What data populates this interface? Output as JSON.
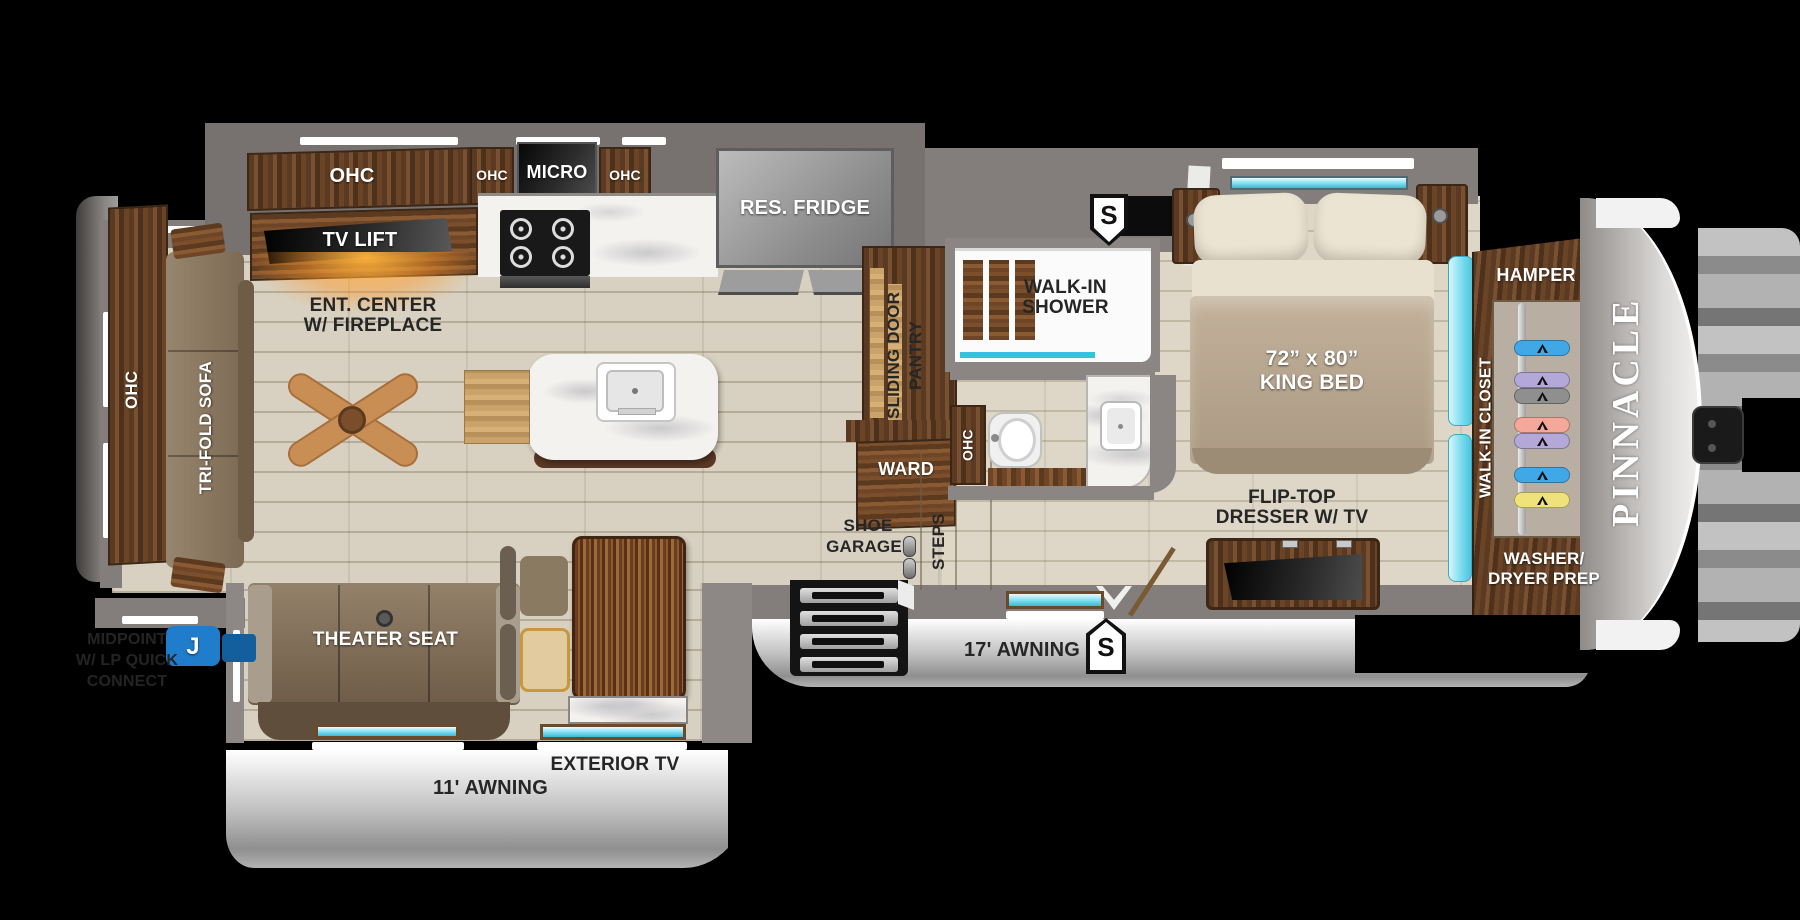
{
  "floorplan": {
    "model_badge": "Pinnacle",
    "colors": {
      "accent_teal": "#4cc3dd",
      "marker_blue": "#1f7dcb",
      "glow_orange": "#f7a832"
    },
    "living": {
      "ohc_rear": "OHC",
      "trifold_sofa": "TRI-FOLD SOFA",
      "theater_seat": "THEATER SEAT",
      "ent_center_l1": "ENT. CENTER",
      "ent_center_l2": "W/ FIREPLACE",
      "tv_lift": "TV LIFT"
    },
    "kitchen": {
      "ohc_main": "OHC",
      "ohc_left": "OHC",
      "micro": "MICRO",
      "ohc_right": "OHC",
      "fridge": "RES. FRIDGE",
      "pantry_l1": "SLIDING DOOR",
      "pantry_l2": "PANTRY",
      "ward": "WARD"
    },
    "entry": {
      "shoe_garage_l1": "SHOE",
      "shoe_garage_l2": "GARAGE",
      "steps": "STEPS"
    },
    "bath": {
      "shower_l1": "WALK-IN",
      "shower_l2": "SHOWER",
      "ohc": "OHC"
    },
    "bedroom": {
      "bed_l1": "72” x 80”",
      "bed_l2": "KING BED",
      "dresser_l1": "FLIP-TOP",
      "dresser_l2": "DRESSER W/ TV"
    },
    "closet": {
      "hamper": "HAMPER",
      "walk_in": "WALK-IN CLOSET",
      "washer_l1": "WASHER/",
      "washer_l2": "DRYER PREP",
      "hangers": [
        {
          "y": 40,
          "color": "#41a8e8"
        },
        {
          "y": 72,
          "color": "#b4a8d8"
        },
        {
          "y": 88,
          "color": "#8f8f8f"
        },
        {
          "y": 117,
          "color": "#f4a899"
        },
        {
          "y": 133,
          "color": "#b4a8d8"
        },
        {
          "y": 167,
          "color": "#41a8e8"
        },
        {
          "y": 192,
          "color": "#efe27a"
        }
      ]
    },
    "exterior": {
      "awning_small": "11' AWNING",
      "awning_large": "17' AWNING",
      "exterior_tv": "EXTERIOR TV",
      "marker_s_top": "S",
      "marker_s_bottom": "S",
      "marker_j": "J",
      "midpoint_l1": "MIDPOINT",
      "midpoint_l2": "W/ LP QUICK",
      "midpoint_l3": "CONNECT"
    }
  }
}
